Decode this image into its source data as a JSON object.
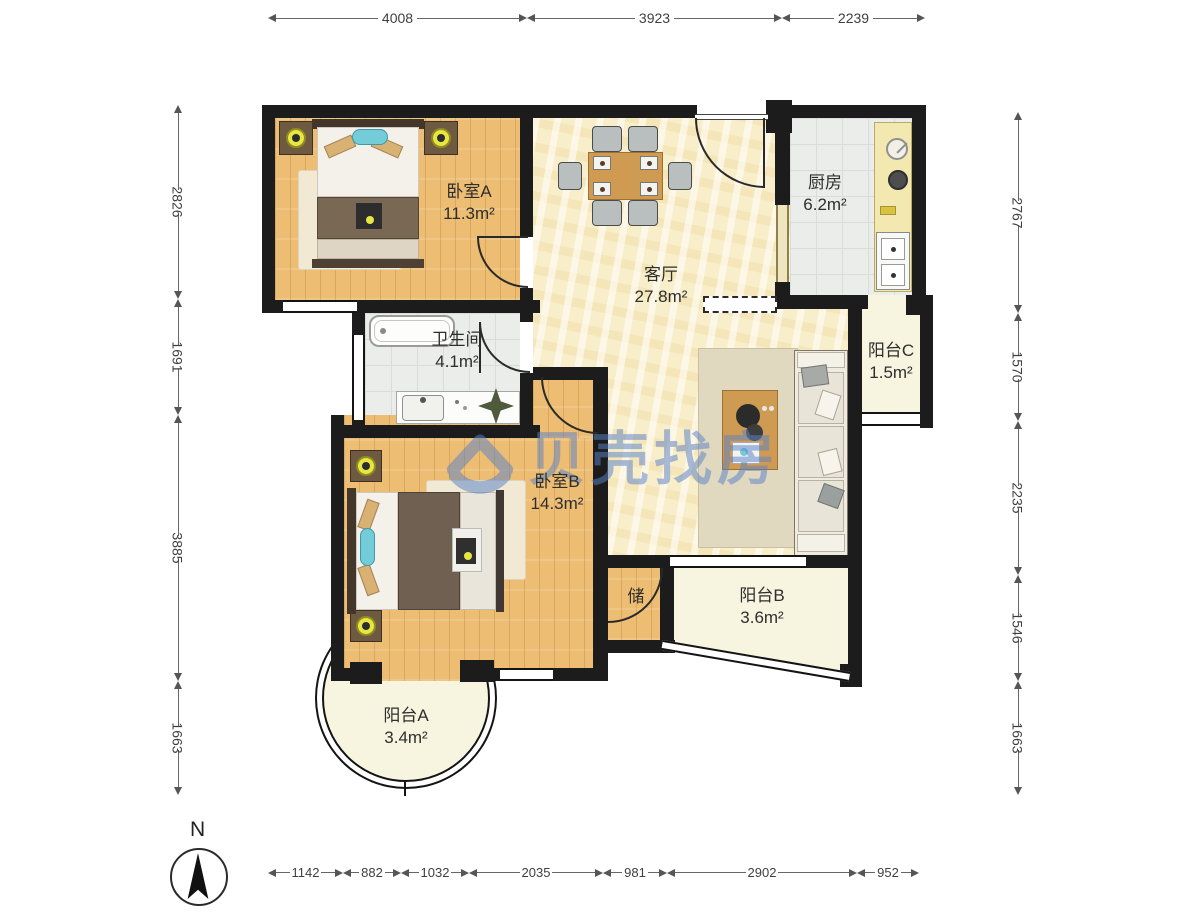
{
  "watermark": {
    "brand": "贝壳找房"
  },
  "compass": {
    "north_label": "N"
  },
  "rooms": [
    {
      "id": "bedroom-a",
      "name": "卧室A",
      "area": "11.3m²"
    },
    {
      "id": "living-room",
      "name": "客厅",
      "area": "27.8m²"
    },
    {
      "id": "kitchen",
      "name": "厨房",
      "area": "6.2m²"
    },
    {
      "id": "bathroom",
      "name": "卫生间",
      "area": "4.1m²"
    },
    {
      "id": "bedroom-b",
      "name": "卧室B",
      "area": "14.3m²"
    },
    {
      "id": "balcony-a",
      "name": "阳台A",
      "area": "3.4m²"
    },
    {
      "id": "balcony-b",
      "name": "阳台B",
      "area": "3.6m²"
    },
    {
      "id": "balcony-c",
      "name": "阳台C",
      "area": "1.5m²"
    },
    {
      "id": "storage",
      "name": "储",
      "area": ""
    }
  ],
  "dimensions_mm": {
    "top": [
      "4008",
      "3923",
      "2239"
    ],
    "left": [
      "2826",
      "1691",
      "3885",
      "1663"
    ],
    "right": [
      "2767",
      "1570",
      "2235",
      "1546",
      "1663"
    ],
    "bottom": [
      "1142",
      "882",
      "1032",
      "2035",
      "981",
      "2902",
      "952"
    ]
  },
  "colors": {
    "wall": "#1c1c1c",
    "wood_floor": "#ecbd72",
    "marble_floor": "#f8eec9",
    "tile_floor": "#ebedeb",
    "balcony_floor": "#f7f5df",
    "watermark_blue": "#5b82c8",
    "accent_teal": "#74ccd8",
    "lamp_yellow": "#e8e642"
  }
}
